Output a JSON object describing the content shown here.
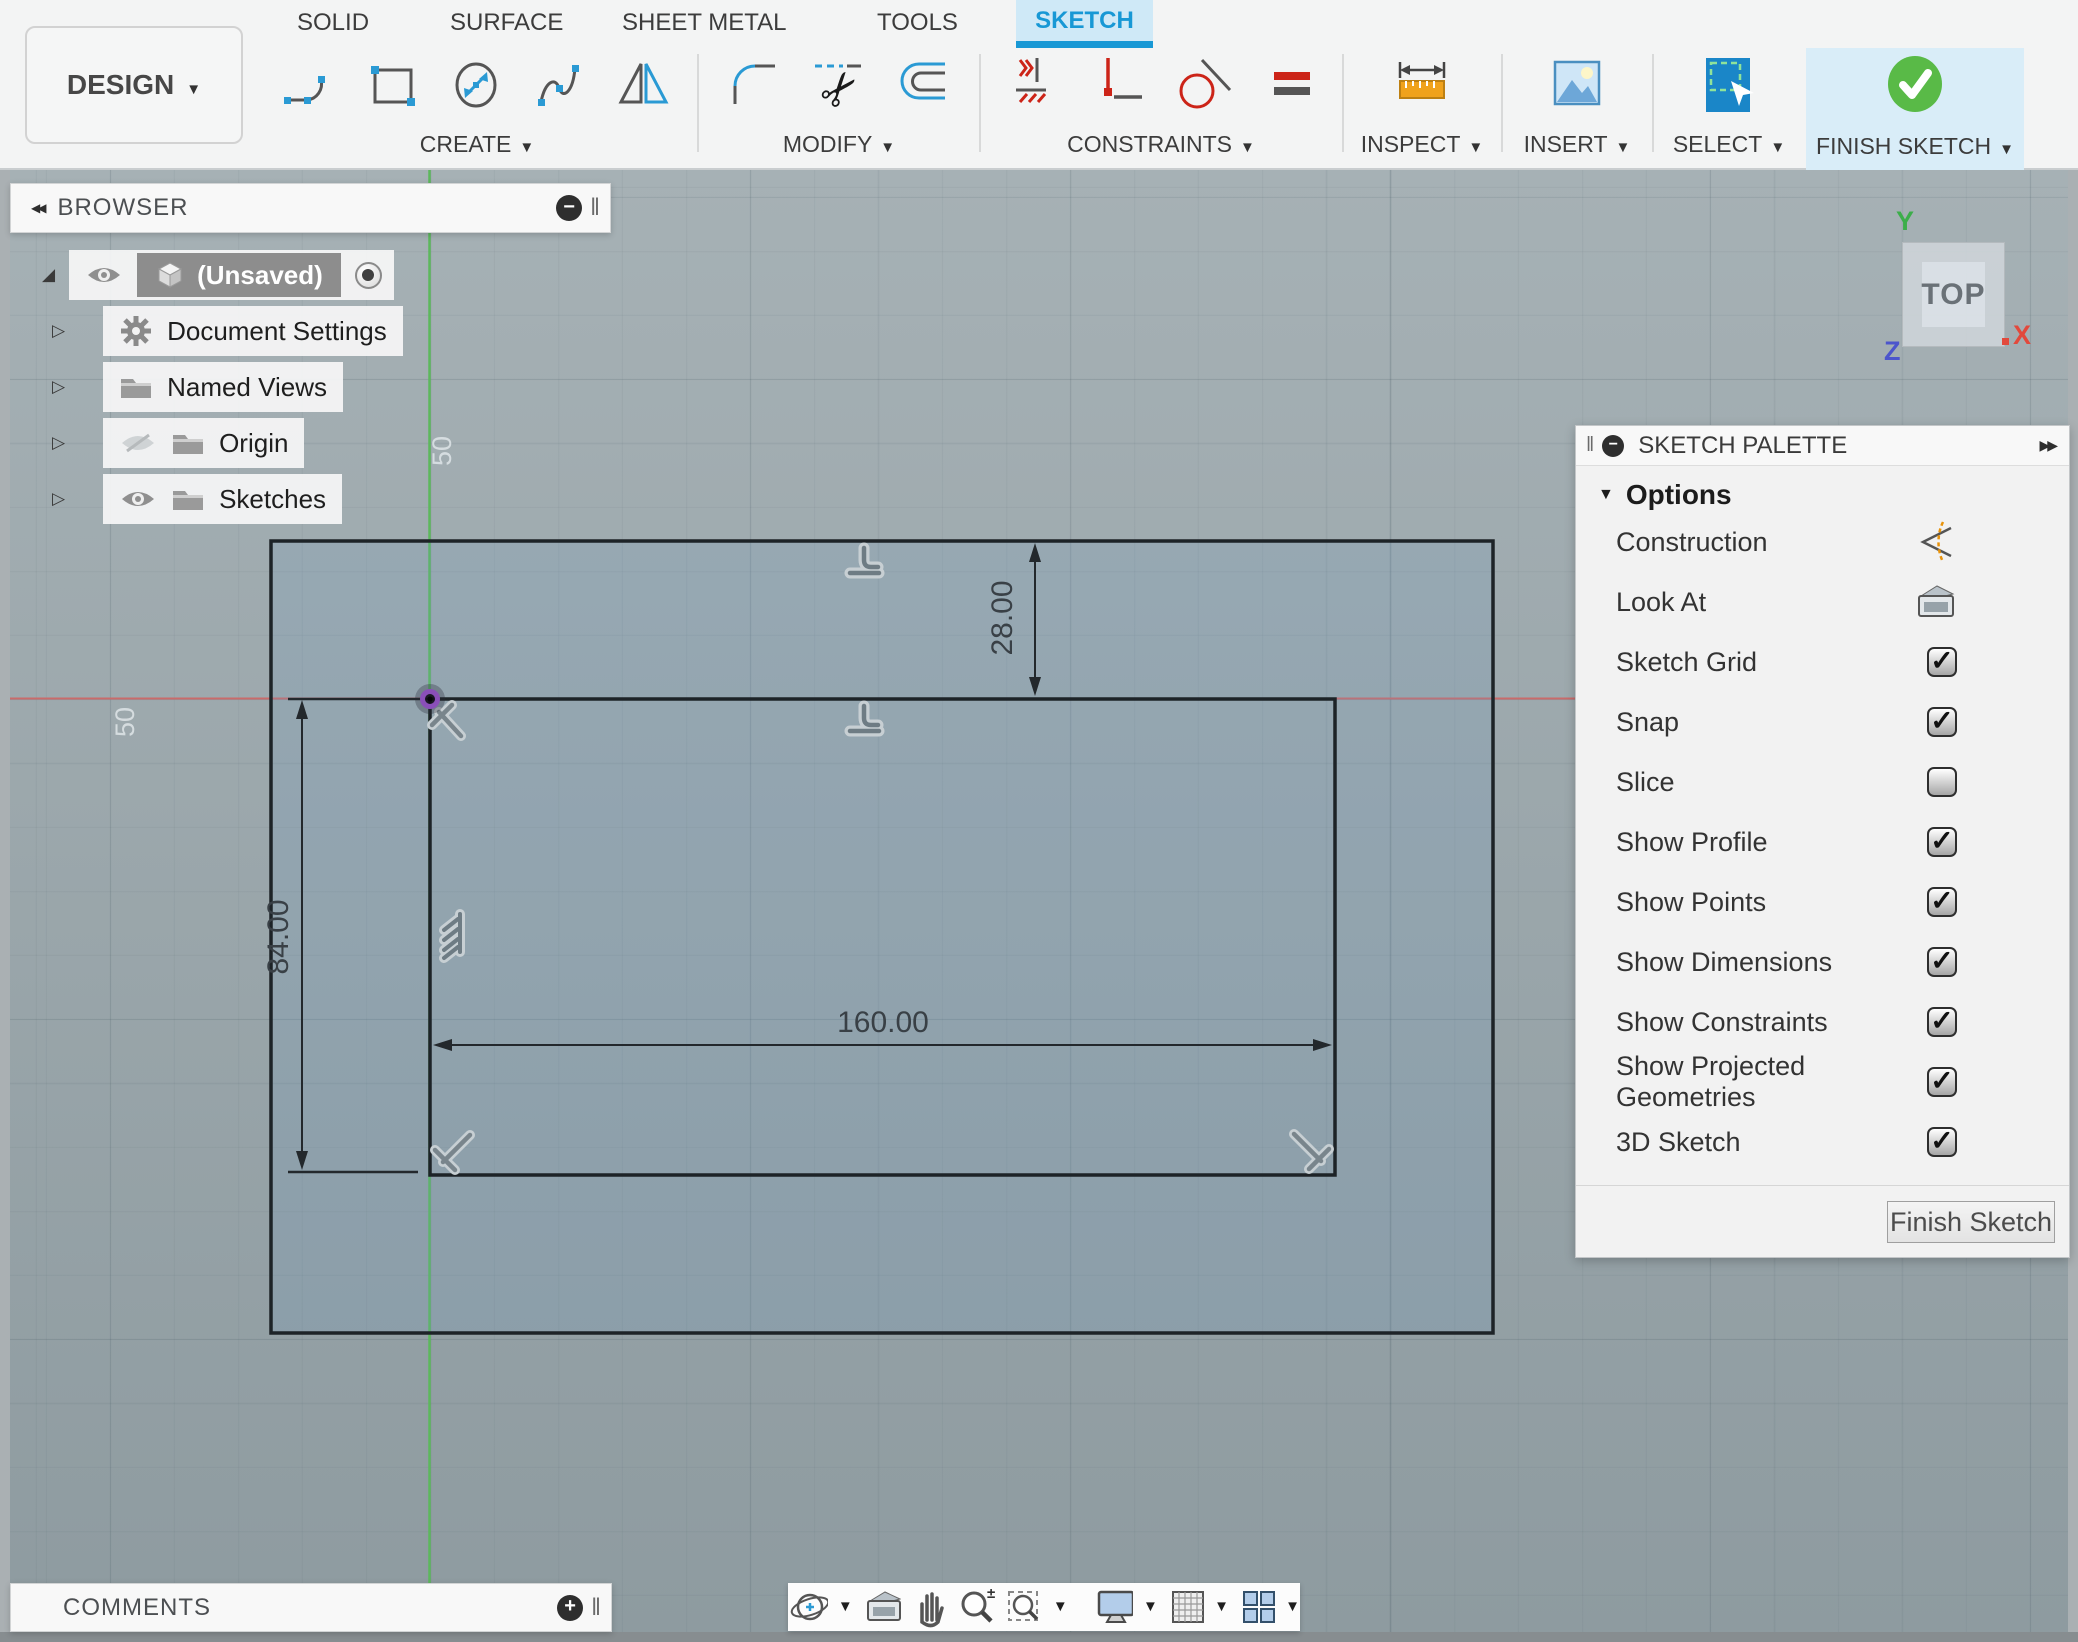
{
  "toolbar": {
    "design_label": "DESIGN",
    "tabs": [
      {
        "label": "SOLID",
        "active": false
      },
      {
        "label": "SURFACE",
        "active": false
      },
      {
        "label": "SHEET METAL",
        "active": false
      },
      {
        "label": "TOOLS",
        "active": false
      },
      {
        "label": "SKETCH",
        "active": true
      }
    ],
    "groups": {
      "create": "CREATE",
      "modify": "MODIFY",
      "constraints": "CONSTRAINTS",
      "inspect": "INSPECT",
      "insert": "INSERT",
      "select": "SELECT",
      "finish": "FINISH SKETCH"
    },
    "accent_blue": "#1898d5",
    "finish_green": "#59ba47",
    "sketch_tab_bg": "#cfe9f7"
  },
  "browser": {
    "title": "BROWSER",
    "items": [
      {
        "label": "(Unsaved)",
        "icons": [
          "eye",
          "cube"
        ],
        "selected": true
      },
      {
        "label": "Document Settings",
        "icons": [
          "gear"
        ]
      },
      {
        "label": "Named Views",
        "icons": [
          "folder"
        ]
      },
      {
        "label": "Origin",
        "icons": [
          "eye-off",
          "folder"
        ]
      },
      {
        "label": "Sketches",
        "icons": [
          "eye",
          "folder"
        ]
      }
    ]
  },
  "palette": {
    "title": "SKETCH PALETTE",
    "section": "Options",
    "rows": [
      {
        "label": "Construction",
        "control": "construction-icon"
      },
      {
        "label": "Look At",
        "control": "look-at-button"
      },
      {
        "label": "Sketch Grid",
        "control": "checkbox",
        "checked": true
      },
      {
        "label": "Snap",
        "control": "checkbox",
        "checked": true
      },
      {
        "label": "Slice",
        "control": "checkbox",
        "checked": false
      },
      {
        "label": "Show Profile",
        "control": "checkbox",
        "checked": true
      },
      {
        "label": "Show Points",
        "control": "checkbox",
        "checked": true
      },
      {
        "label": "Show Dimensions",
        "control": "checkbox",
        "checked": true
      },
      {
        "label": "Show Constraints",
        "control": "checkbox",
        "checked": true
      },
      {
        "label": "Show Projected Geometries",
        "control": "checkbox",
        "checked": true
      },
      {
        "label": "3D Sketch",
        "control": "checkbox",
        "checked": true
      }
    ],
    "finish_button": "Finish Sketch"
  },
  "viewcube": {
    "face": "TOP",
    "axis_x": "X",
    "axis_y": "Y",
    "axis_z": "Z"
  },
  "canvas": {
    "dimensions": {
      "offset_top": "28.00",
      "height": "84.00",
      "width": "160.00"
    },
    "grid_labels": {
      "top": "50",
      "left": "50"
    },
    "axis_x_color": "#c96b6b",
    "axis_y_color": "#5cb85c",
    "origin_color": "#8a4fb8"
  },
  "comments": {
    "title": "COMMENTS"
  },
  "nav": {
    "icons": [
      "orbit",
      "look-at",
      "pan",
      "zoom",
      "zoom-window",
      "display-settings",
      "grid-snaps",
      "viewports"
    ]
  }
}
